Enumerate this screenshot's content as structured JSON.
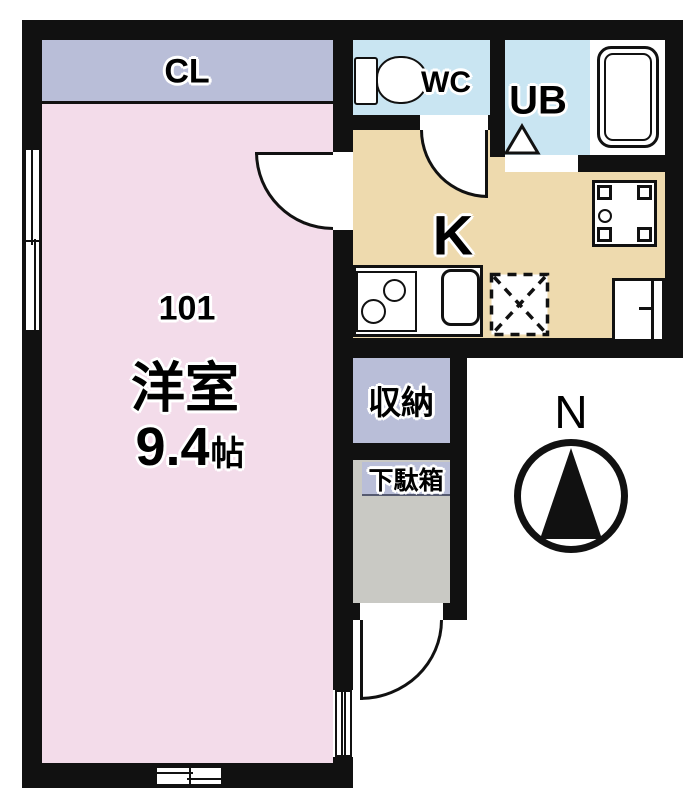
{
  "plan": {
    "unit_number": "101",
    "main_room": {
      "name": "洋室",
      "size_value": "9.4",
      "size_unit": "帖"
    },
    "labels": {
      "closet": "CL",
      "toilet": "WC",
      "unit_bath": "UB",
      "kitchen": "K",
      "storage": "収納",
      "shoe_cabinet": "下駄箱"
    },
    "compass": {
      "north": "N"
    },
    "colors": {
      "wall": "#111111",
      "main_room_fill": "#f3dcea",
      "closet_fill": "#b9bed8",
      "wet_area_fill": "#c9e5f2",
      "kitchen_fill": "#eedaae",
      "entrance_fill": "#c9c9c4",
      "fixture_fill": "#ffffff",
      "label_halo": "#ffffff"
    }
  }
}
